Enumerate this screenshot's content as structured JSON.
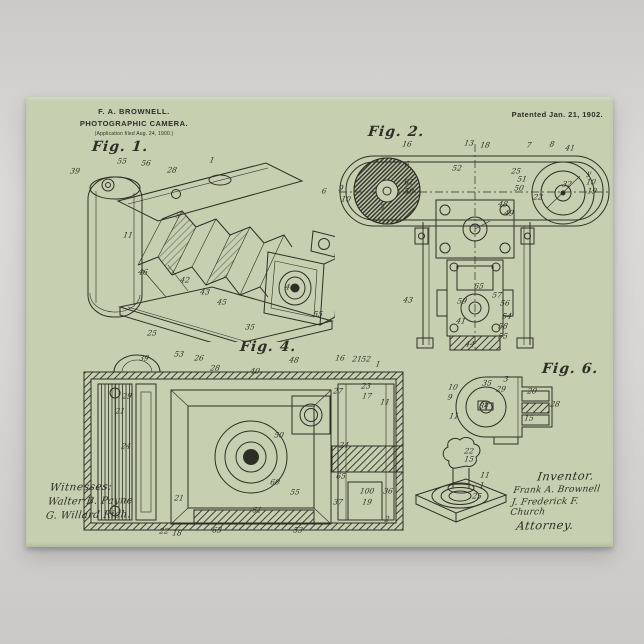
{
  "poster": {
    "colors": {
      "paper": "#c6cfb0",
      "ink": "#2d2f27",
      "bg": "#d3d1cf"
    },
    "header": {
      "inventor_name": "F. A. BROWNELL.",
      "title": "PHOTOGRAPHIC CAMERA.",
      "application_line": "(Application filed Aug. 24, 1900.)",
      "patent_date": "Patented Jan. 21, 1902."
    },
    "figures": {
      "fig1": {
        "label": "Fig. 1.",
        "refs": [
          {
            "x": 5,
            "y": 24,
            "t": "39"
          },
          {
            "x": 52,
            "y": 14,
            "t": "55"
          },
          {
            "x": 76,
            "y": 16,
            "t": "56"
          },
          {
            "x": 102,
            "y": 23,
            "t": "28"
          },
          {
            "x": 142,
            "y": 13,
            "t": "1"
          },
          {
            "x": 108,
            "y": 68,
            "t": "5"
          },
          {
            "x": 58,
            "y": 88,
            "t": "11"
          },
          {
            "x": 73,
            "y": 125,
            "t": "46"
          },
          {
            "x": 115,
            "y": 133,
            "t": "42"
          },
          {
            "x": 135,
            "y": 145,
            "t": "43"
          },
          {
            "x": 152,
            "y": 155,
            "t": "45"
          },
          {
            "x": 220,
            "y": 140,
            "t": "40"
          },
          {
            "x": 82,
            "y": 186,
            "t": "25"
          },
          {
            "x": 180,
            "y": 180,
            "t": "35"
          },
          {
            "x": 248,
            "y": 167,
            "t": "55"
          },
          {
            "x": 254,
            "y": 44,
            "t": "6"
          }
        ]
      },
      "fig2": {
        "label": "Fig. 2.",
        "refs": [
          {
            "x": 132,
            "y": 3,
            "t": "13"
          },
          {
            "x": 148,
            "y": 5,
            "t": "18"
          },
          {
            "x": 192,
            "y": 5,
            "t": "7"
          },
          {
            "x": 215,
            "y": 4,
            "t": "8"
          },
          {
            "x": 233,
            "y": 8,
            "t": "41"
          },
          {
            "x": 70,
            "y": 4,
            "t": "16"
          },
          {
            "x": 70,
            "y": 24,
            "t": "6"
          },
          {
            "x": 120,
            "y": 28,
            "t": "52"
          },
          {
            "x": 72,
            "y": 42,
            "t": "61"
          },
          {
            "x": 72,
            "y": 51,
            "t": "50"
          },
          {
            "x": 179,
            "y": 31,
            "t": "25"
          },
          {
            "x": 185,
            "y": 39,
            "t": "51"
          },
          {
            "x": 182,
            "y": 48,
            "t": "50"
          },
          {
            "x": 201,
            "y": 57,
            "t": "22"
          },
          {
            "x": 252,
            "y": 33,
            "t": "y"
          },
          {
            "x": 254,
            "y": 42,
            "t": "10"
          },
          {
            "x": 255,
            "y": 51,
            "t": "19"
          },
          {
            "x": 230,
            "y": 44,
            "t": "32"
          },
          {
            "x": 4,
            "y": 48,
            "t": "9"
          },
          {
            "x": 9,
            "y": 59,
            "t": "10"
          },
          {
            "x": 45,
            "y": 67,
            "t": "3"
          },
          {
            "x": 166,
            "y": 64,
            "t": "48"
          },
          {
            "x": 172,
            "y": 73,
            "t": "49"
          },
          {
            "x": 71,
            "y": 160,
            "t": "43"
          },
          {
            "x": 160,
            "y": 155,
            "t": "57"
          },
          {
            "x": 168,
            "y": 163,
            "t": "56"
          },
          {
            "x": 170,
            "y": 176,
            "t": "54"
          },
          {
            "x": 166,
            "y": 186,
            "t": "58"
          },
          {
            "x": 166,
            "y": 196,
            "t": "55"
          },
          {
            "x": 125,
            "y": 161,
            "t": "59"
          },
          {
            "x": 124,
            "y": 181,
            "t": "41"
          },
          {
            "x": 133,
            "y": 204,
            "t": "44"
          },
          {
            "x": 142,
            "y": 146,
            "t": "65"
          }
        ]
      },
      "fig4": {
        "label": "Fig. 4.",
        "refs": [
          {
            "x": 68,
            "y": 6,
            "t": "39"
          },
          {
            "x": 103,
            "y": 2,
            "t": "53"
          },
          {
            "x": 123,
            "y": 6,
            "t": "26"
          },
          {
            "x": 139,
            "y": 16,
            "t": "28"
          },
          {
            "x": 179,
            "y": 19,
            "t": "40"
          },
          {
            "x": 218,
            "y": 8,
            "t": "48"
          },
          {
            "x": 264,
            "y": 6,
            "t": "16"
          },
          {
            "x": 281,
            "y": 7,
            "t": "21"
          },
          {
            "x": 290,
            "y": 7,
            "t": "52"
          },
          {
            "x": 302,
            "y": 12,
            "t": "1"
          },
          {
            "x": 290,
            "y": 34,
            "t": "23"
          },
          {
            "x": 291,
            "y": 44,
            "t": "17"
          },
          {
            "x": 309,
            "y": 50,
            "t": "11"
          },
          {
            "x": 262,
            "y": 39,
            "t": "27"
          },
          {
            "x": 51,
            "y": 44,
            "t": "29"
          },
          {
            "x": 44,
            "y": 59,
            "t": "21"
          },
          {
            "x": 50,
            "y": 94,
            "t": "24"
          },
          {
            "x": 268,
            "y": 93,
            "t": "24"
          },
          {
            "x": 265,
            "y": 124,
            "t": "65"
          },
          {
            "x": 291,
            "y": 139,
            "t": "100"
          },
          {
            "x": 312,
            "y": 139,
            "t": "36"
          },
          {
            "x": 262,
            "y": 150,
            "t": "37"
          },
          {
            "x": 291,
            "y": 150,
            "t": "19"
          },
          {
            "x": 311,
            "y": 167,
            "t": "2"
          },
          {
            "x": 199,
            "y": 130,
            "t": "60"
          },
          {
            "x": 219,
            "y": 140,
            "t": "55"
          },
          {
            "x": 181,
            "y": 158,
            "t": "61"
          },
          {
            "x": 141,
            "y": 178,
            "t": "63"
          },
          {
            "x": 222,
            "y": 178,
            "t": "53"
          },
          {
            "x": 101,
            "y": 181,
            "t": "18"
          },
          {
            "x": 88,
            "y": 179,
            "t": "22"
          },
          {
            "x": 103,
            "y": 146,
            "t": "21"
          },
          {
            "x": 203,
            "y": 83,
            "t": "50"
          }
        ]
      },
      "fig6": {
        "label": "Fig. 6.",
        "refs": [
          {
            "x": 29,
            "y": 22,
            "t": "10"
          },
          {
            "x": 26,
            "y": 32,
            "t": "9"
          },
          {
            "x": 30,
            "y": 51,
            "t": "11"
          },
          {
            "x": 63,
            "y": 18,
            "t": "35"
          },
          {
            "x": 77,
            "y": 24,
            "t": "29"
          },
          {
            "x": 60,
            "y": 41,
            "t": "34"
          },
          {
            "x": 82,
            "y": 14,
            "t": "3"
          },
          {
            "x": 108,
            "y": 26,
            "t": "20"
          },
          {
            "x": 131,
            "y": 39,
            "t": "28"
          },
          {
            "x": 105,
            "y": 53,
            "t": "15"
          }
        ]
      },
      "fig5": {
        "refs": [
          {
            "x": 61,
            "y": 14,
            "t": "22"
          },
          {
            "x": 61,
            "y": 22,
            "t": "15"
          },
          {
            "x": 77,
            "y": 38,
            "t": "11"
          },
          {
            "x": 74,
            "y": 48,
            "t": "1"
          },
          {
            "x": 69,
            "y": 59,
            "t": "25"
          }
        ]
      }
    },
    "signatures": {
      "witnesses_label": "Witnesses:",
      "witness1": "Walter B. Payne",
      "witness2": "G. Willard Rich.",
      "inventor_label": "Inventor.",
      "inventor_signature": "Frank A. Brownell",
      "attorney_signature": "J. Frederick F. Church",
      "attorney_label": "Attorney."
    }
  }
}
